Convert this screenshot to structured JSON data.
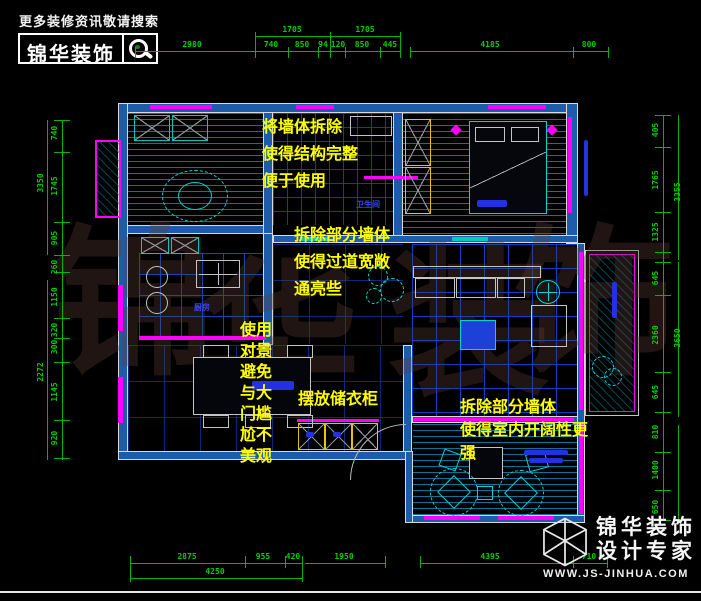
{
  "header": {
    "slogan": "更多装修资讯敬请搜索",
    "logo_text": "锦华装饰"
  },
  "footer": {
    "brand_line1": "锦华装饰",
    "brand_line2": "设计专家",
    "website": "WWW.JS-JINHUA.COM"
  },
  "watermark": {
    "marks": [
      {
        "ch": "锦",
        "x": 52,
        "y": 224
      },
      {
        "ch": "华",
        "x": 198,
        "y": 258
      },
      {
        "ch": "装",
        "x": 388,
        "y": 244
      },
      {
        "ch": "饰",
        "x": 514,
        "y": 224
      }
    ]
  },
  "annotations": [
    {
      "lines": [
        "将墙体拆除",
        "使得结构完整",
        "便于使用"
      ]
    },
    {
      "lines": [
        "拆除部分墙体",
        "使得过道宽敞",
        "通亮些"
      ]
    },
    {
      "lines": [
        "使用",
        "对景",
        "避免",
        "与大",
        "门尴",
        "尬不",
        "美观"
      ]
    },
    {
      "lines": [
        "摆放储衣柜"
      ]
    },
    {
      "lines": [
        "拆除部分墙体",
        "使得室内开阔性更",
        "强"
      ]
    }
  ],
  "room_labels": {
    "kitchen": "厨房",
    "bathroom": "卫生间"
  },
  "dimensions": {
    "labels": [
      {
        "t": "2980",
        "x": 192,
        "y": 45
      },
      {
        "t": "1705",
        "x": 292,
        "y": 30
      },
      {
        "t": "1705",
        "x": 365,
        "y": 30
      },
      {
        "t": "740",
        "x": 271,
        "y": 45
      },
      {
        "t": "850",
        "x": 302,
        "y": 45
      },
      {
        "t": "94",
        "x": 323,
        "y": 45
      },
      {
        "t": "120",
        "x": 338,
        "y": 45
      },
      {
        "t": "850",
        "x": 362,
        "y": 45
      },
      {
        "t": "445",
        "x": 390,
        "y": 45
      },
      {
        "t": "4185",
        "x": 490,
        "y": 45
      },
      {
        "t": "800",
        "x": 589,
        "y": 45
      },
      {
        "t": "740",
        "x": 55,
        "y": 133,
        "r": 1
      },
      {
        "t": "1745",
        "x": 55,
        "y": 186,
        "r": 1
      },
      {
        "t": "905",
        "x": 55,
        "y": 238,
        "r": 1
      },
      {
        "t": "3350",
        "x": 41,
        "y": 183,
        "r": 1
      },
      {
        "t": "260",
        "x": 55,
        "y": 267,
        "r": 1
      },
      {
        "t": "1150",
        "x": 55,
        "y": 297,
        "r": 1
      },
      {
        "t": "320",
        "x": 55,
        "y": 330,
        "r": 1
      },
      {
        "t": "300",
        "x": 55,
        "y": 347,
        "r": 1
      },
      {
        "t": "1145",
        "x": 55,
        "y": 392,
        "r": 1
      },
      {
        "t": "920",
        "x": 55,
        "y": 438,
        "r": 1
      },
      {
        "t": "2272",
        "x": 41,
        "y": 372,
        "r": 1
      },
      {
        "t": "405",
        "x": 656,
        "y": 130,
        "r": 1
      },
      {
        "t": "1765",
        "x": 656,
        "y": 180,
        "r": 1
      },
      {
        "t": "1325",
        "x": 656,
        "y": 232,
        "r": 1
      },
      {
        "t": "3355",
        "x": 678,
        "y": 192,
        "r": 1
      },
      {
        "t": "645",
        "x": 656,
        "y": 278,
        "r": 1
      },
      {
        "t": "2360",
        "x": 656,
        "y": 335,
        "r": 1
      },
      {
        "t": "3650",
        "x": 678,
        "y": 338,
        "r": 1
      },
      {
        "t": "645",
        "x": 656,
        "y": 392,
        "r": 1
      },
      {
        "t": "810",
        "x": 656,
        "y": 432,
        "r": 1
      },
      {
        "t": "1400",
        "x": 656,
        "y": 470,
        "r": 1
      },
      {
        "t": "650",
        "x": 656,
        "y": 507,
        "r": 1
      },
      {
        "t": "2875",
        "x": 187,
        "y": 557
      },
      {
        "t": "955",
        "x": 263,
        "y": 557
      },
      {
        "t": "420",
        "x": 293,
        "y": 557
      },
      {
        "t": "1950",
        "x": 344,
        "y": 557
      },
      {
        "t": "4395",
        "x": 490,
        "y": 557
      },
      {
        "t": "710",
        "x": 589,
        "y": 557
      },
      {
        "t": "4250",
        "x": 215,
        "y": 572
      }
    ],
    "lines": [
      {
        "x": 135,
        "y": 51,
        "w": 120,
        "h": 1
      },
      {
        "x": 255,
        "y": 36,
        "w": 75,
        "h": 1
      },
      {
        "x": 330,
        "y": 36,
        "w": 70,
        "h": 1
      },
      {
        "x": 255,
        "y": 51,
        "w": 145,
        "h": 1
      },
      {
        "x": 410,
        "y": 51,
        "w": 163,
        "h": 1
      },
      {
        "x": 573,
        "y": 51,
        "w": 35,
        "h": 1
      },
      {
        "x": 135,
        "y": 47,
        "w": 1,
        "h": 11
      },
      {
        "x": 255,
        "y": 32,
        "w": 1,
        "h": 26
      },
      {
        "x": 288,
        "y": 47,
        "w": 1,
        "h": 11
      },
      {
        "x": 318,
        "y": 47,
        "w": 1,
        "h": 11
      },
      {
        "x": 330,
        "y": 32,
        "w": 1,
        "h": 26
      },
      {
        "x": 345,
        "y": 47,
        "w": 1,
        "h": 11
      },
      {
        "x": 380,
        "y": 47,
        "w": 1,
        "h": 11
      },
      {
        "x": 400,
        "y": 32,
        "w": 1,
        "h": 26
      },
      {
        "x": 410,
        "y": 47,
        "w": 1,
        "h": 11
      },
      {
        "x": 573,
        "y": 47,
        "w": 1,
        "h": 11
      },
      {
        "x": 608,
        "y": 47,
        "w": 1,
        "h": 11
      },
      {
        "x": 62,
        "y": 120,
        "w": 1,
        "h": 340
      },
      {
        "x": 47,
        "y": 120,
        "w": 1,
        "h": 135
      },
      {
        "x": 47,
        "y": 280,
        "w": 1,
        "h": 180
      },
      {
        "x": 54,
        "y": 120,
        "w": 16,
        "h": 1
      },
      {
        "x": 54,
        "y": 152,
        "w": 16,
        "h": 1
      },
      {
        "x": 54,
        "y": 222,
        "w": 16,
        "h": 1
      },
      {
        "x": 54,
        "y": 255,
        "w": 16,
        "h": 1
      },
      {
        "x": 54,
        "y": 272,
        "w": 16,
        "h": 1
      },
      {
        "x": 54,
        "y": 318,
        "w": 16,
        "h": 1
      },
      {
        "x": 54,
        "y": 338,
        "w": 16,
        "h": 1
      },
      {
        "x": 54,
        "y": 362,
        "w": 16,
        "h": 1
      },
      {
        "x": 54,
        "y": 420,
        "w": 16,
        "h": 1
      },
      {
        "x": 54,
        "y": 458,
        "w": 16,
        "h": 1
      },
      {
        "x": 663,
        "y": 115,
        "w": 1,
        "h": 405
      },
      {
        "x": 678,
        "y": 115,
        "w": 1,
        "h": 145
      },
      {
        "x": 678,
        "y": 262,
        "w": 1,
        "h": 155
      },
      {
        "x": 678,
        "y": 425,
        "w": 1,
        "h": 95
      },
      {
        "x": 655,
        "y": 115,
        "w": 16,
        "h": 1
      },
      {
        "x": 655,
        "y": 147,
        "w": 16,
        "h": 1
      },
      {
        "x": 655,
        "y": 212,
        "w": 16,
        "h": 1
      },
      {
        "x": 655,
        "y": 252,
        "w": 16,
        "h": 1
      },
      {
        "x": 655,
        "y": 262,
        "w": 16,
        "h": 1
      },
      {
        "x": 655,
        "y": 295,
        "w": 16,
        "h": 1
      },
      {
        "x": 655,
        "y": 372,
        "w": 16,
        "h": 1
      },
      {
        "x": 655,
        "y": 412,
        "w": 16,
        "h": 1
      },
      {
        "x": 655,
        "y": 452,
        "w": 16,
        "h": 1
      },
      {
        "x": 655,
        "y": 490,
        "w": 16,
        "h": 1
      },
      {
        "x": 655,
        "y": 520,
        "w": 16,
        "h": 1
      },
      {
        "x": 130,
        "y": 563,
        "w": 172,
        "h": 1
      },
      {
        "x": 305,
        "y": 563,
        "w": 80,
        "h": 1
      },
      {
        "x": 420,
        "y": 563,
        "w": 153,
        "h": 1
      },
      {
        "x": 573,
        "y": 563,
        "w": 34,
        "h": 1
      },
      {
        "x": 130,
        "y": 578,
        "w": 172,
        "h": 1
      },
      {
        "x": 130,
        "y": 556,
        "w": 1,
        "h": 26
      },
      {
        "x": 245,
        "y": 556,
        "w": 1,
        "h": 12
      },
      {
        "x": 285,
        "y": 556,
        "w": 1,
        "h": 12
      },
      {
        "x": 302,
        "y": 556,
        "w": 1,
        "h": 26
      },
      {
        "x": 385,
        "y": 556,
        "w": 1,
        "h": 12
      },
      {
        "x": 420,
        "y": 556,
        "w": 1,
        "h": 12
      },
      {
        "x": 573,
        "y": 556,
        "w": 1,
        "h": 12
      },
      {
        "x": 607,
        "y": 556,
        "w": 1,
        "h": 12
      }
    ]
  }
}
